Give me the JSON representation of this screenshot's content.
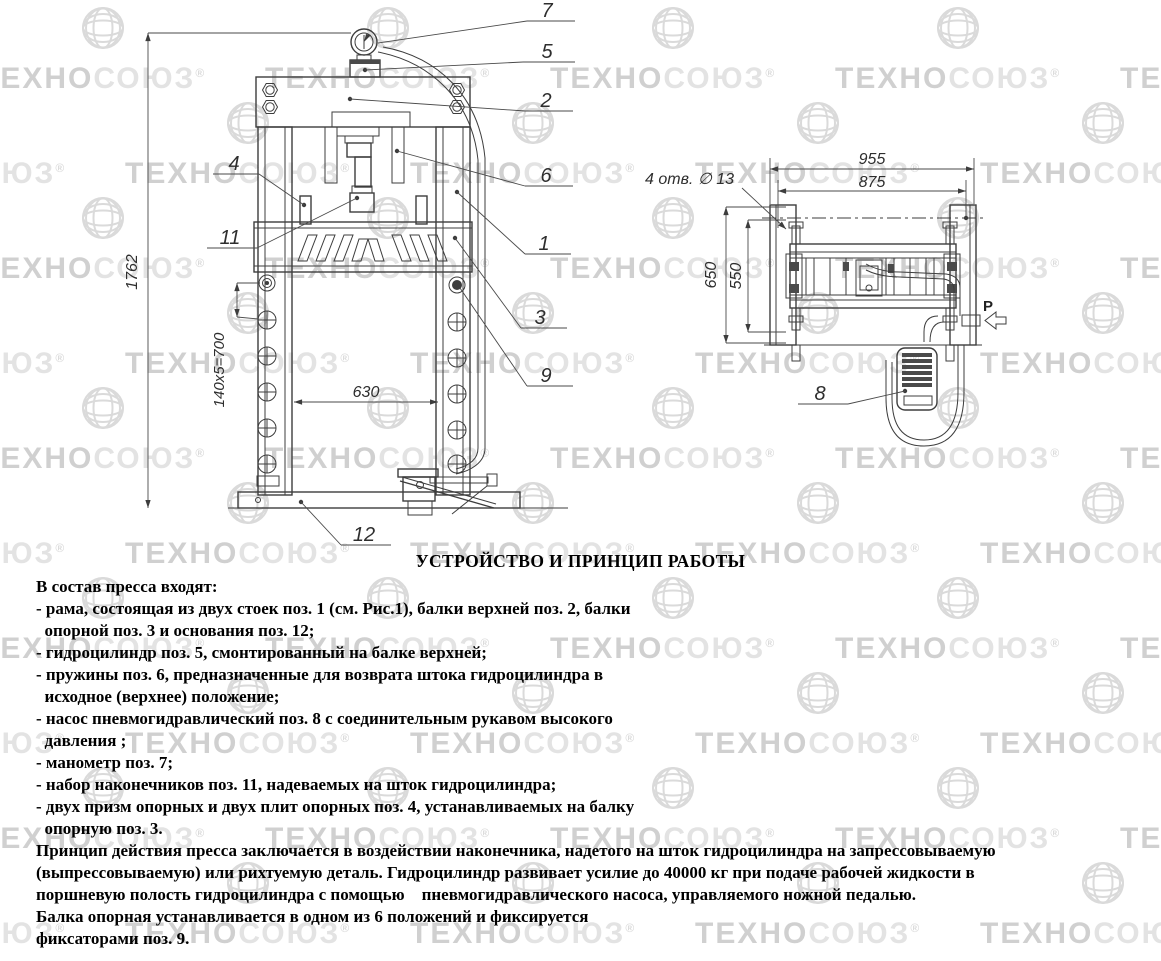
{
  "watermark": {
    "brand": "ТЕХНОСОЮЗ",
    "brand_left": "ТЕХНО",
    "brand_right": "СОЮЗ",
    "registered": "®"
  },
  "title": "УСТРОЙСТВО И ПРИНЦИП РАБОТЫ",
  "body": {
    "lines": [
      "В состав пресса входят:",
      "- рама, состоящая из двух стоек поз. 1 (см. Рис.1), балки верхней поз. 2, балки",
      "  опорной поз. 3 и основания поз. 12;",
      "- гидроцилиндр поз. 5, смонтированный на балке верхней;",
      "- пружины поз. 6, предназначенные для возврата штока гидроцилиндра в",
      "  исходное (верхнее) положение;",
      "- насос пневмогидравлический поз. 8 с соединительным рукавом высокого",
      "  давления ;",
      "- манометр поз. 7;",
      "- набор наконечников поз. 11, надеваемых на шток гидроцилиндра;",
      "- двух призм опорных и двух плит опорных поз. 4, устанавливаемых на балку",
      "  опорную поз. 3.",
      "Принцип действия пресса заключается в воздействии наконечника, надетого на шток гидроцилиндра на запрессовываемую",
      "(выпрессовываемую) или рихтуемую деталь. Гидроцилиндр развивает усилие до 40000 кг при подаче рабочей жидкости в",
      "поршневую полость гидроцилиндра с помощью    пневмогидравлического насоса, управляемого ножной педалью.",
      "Балка опорная устанавливается в одном из 6 положений и фиксируется",
      "фиксаторами поз. 9."
    ]
  },
  "front_view": {
    "callouts": {
      "c1": "1",
      "c2": "2",
      "c3": "3",
      "c4": "4",
      "c5": "5",
      "c6": "6",
      "c7": "7",
      "c9": "9",
      "c11": "11",
      "c12": "12"
    },
    "dims": {
      "height": "1762",
      "pitch": "140х5=700",
      "span": "630"
    }
  },
  "side_view": {
    "callouts": {
      "c8": "8"
    },
    "dims": {
      "overall": "955",
      "inner": "875",
      "depth": "650",
      "depth_inner": "550",
      "holes": "4 отв. ∅ 13"
    },
    "pressure": "P"
  },
  "colors": {
    "line": "#3d3d3d",
    "watermark": "#dddddd"
  }
}
